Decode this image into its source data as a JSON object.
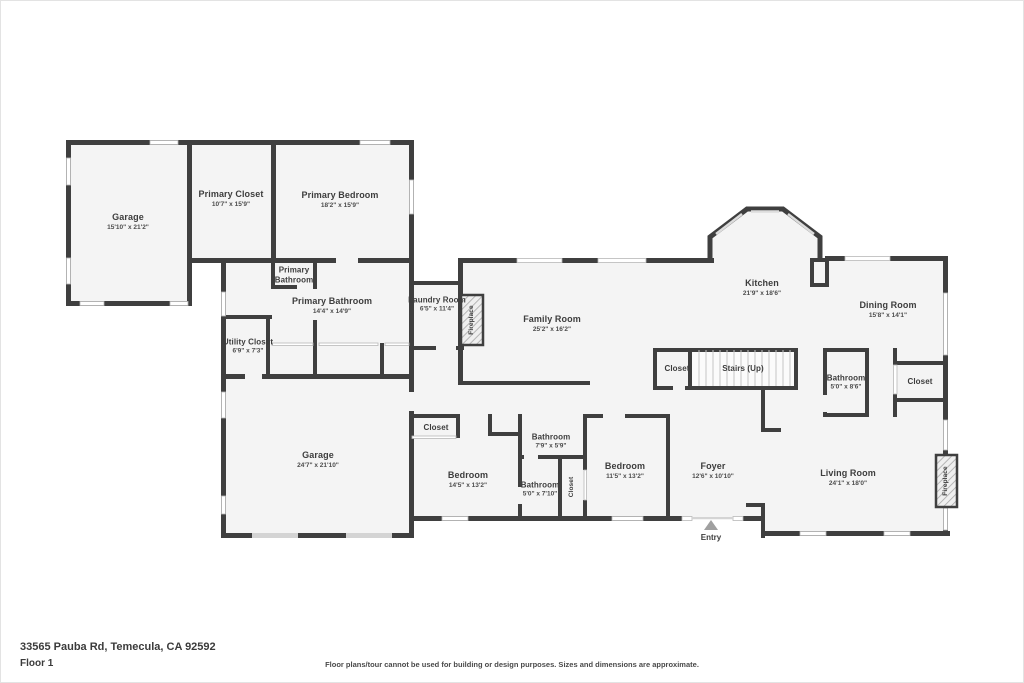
{
  "fp": {
    "address": "33565 Pauba Rd, Temecula, CA 92592",
    "floor_label": "Floor 1",
    "disclaimer": "Floor plans/tour cannot be used for building or design purposes. Sizes and dimensions are approximate.",
    "entry_label": "Entry",
    "colors": {
      "wall": "#3f3f3f",
      "floor": "#f4f4f4",
      "window_line": "#b8b8b8",
      "label_text": "#3d3d3d",
      "entry_arrow": "#a0a0a0"
    },
    "rooms": [
      {
        "name": "Garage",
        "dims": "15'10\" x 21'2\""
      },
      {
        "name": "Primary Closet",
        "dims": "10'7\" x 15'9\""
      },
      {
        "name": "Primary Bedroom",
        "dims": "18'2\" x 15'9\""
      },
      {
        "name": "Primary Bathroom",
        "dims": ""
      },
      {
        "name": "Primary Bathroom",
        "dims": "14'4\" x 14'9\""
      },
      {
        "name": "Utility Closet",
        "dims": "6'9\" x 7'3\""
      },
      {
        "name": "Laundry Room",
        "dims": "6'5\" x 11'4\""
      },
      {
        "name": "Fireplace",
        "dims": ""
      },
      {
        "name": "Family Room",
        "dims": "25'2\" x 16'2\""
      },
      {
        "name": "Kitchen",
        "dims": "21'9\" x 18'6\""
      },
      {
        "name": "Dining Room",
        "dims": "15'8\" x 14'1\""
      },
      {
        "name": "Closet",
        "dims": ""
      },
      {
        "name": "Stairs (Up)",
        "dims": ""
      },
      {
        "name": "Bathroom",
        "dims": "5'0\" x 8'6\""
      },
      {
        "name": "Closet",
        "dims": ""
      },
      {
        "name": "Garage",
        "dims": "24'7\" x 21'10\""
      },
      {
        "name": "Closet",
        "dims": ""
      },
      {
        "name": "Bedroom",
        "dims": "14'5\" x 13'2\""
      },
      {
        "name": "Bathroom",
        "dims": "7'9\" x 5'9\""
      },
      {
        "name": "Bathroom",
        "dims": "5'0\" x 7'10\""
      },
      {
        "name": "Closet",
        "dims": ""
      },
      {
        "name": "Bedroom",
        "dims": "11'5\" x 13'2\""
      },
      {
        "name": "Foyer",
        "dims": "12'6\" x 10'10\""
      },
      {
        "name": "Living Room",
        "dims": "24'1\" x 18'0\""
      },
      {
        "name": "Fireplace",
        "dims": ""
      }
    ]
  }
}
